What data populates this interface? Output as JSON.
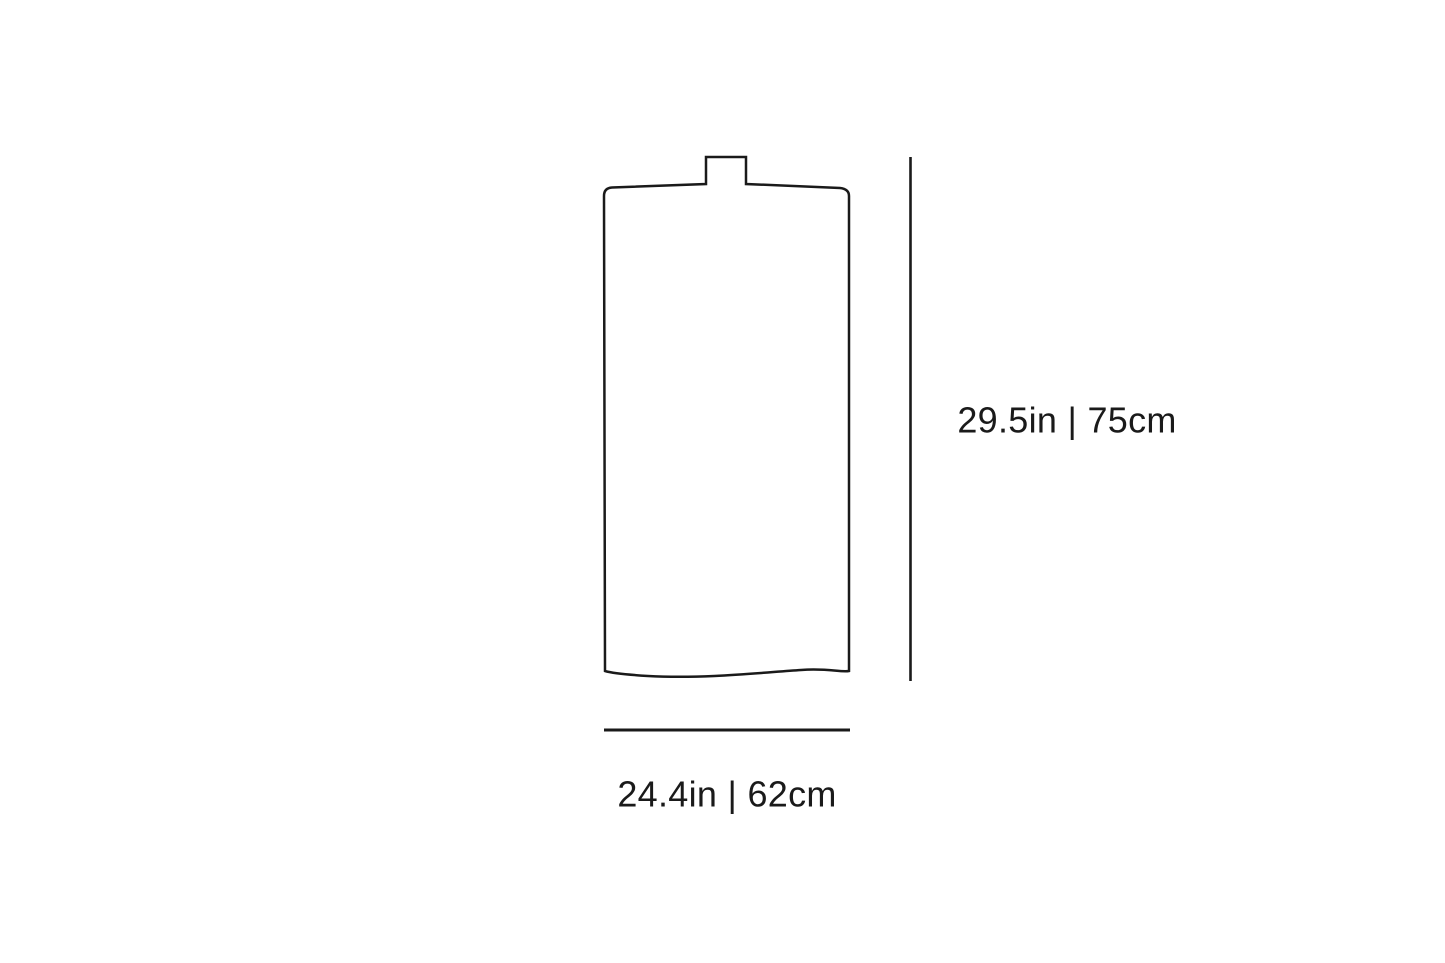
{
  "diagram": {
    "line_color": "#1a1a1a",
    "text_color": "#1a1a1a",
    "background_color": "#ffffff",
    "height_dimension": {
      "label": "29.5in | 75cm",
      "inches": "29.5in",
      "centimeters": "75cm"
    },
    "width_dimension": {
      "label": "24.4in | 62cm",
      "inches": "24.4in",
      "centimeters": "62cm"
    }
  }
}
